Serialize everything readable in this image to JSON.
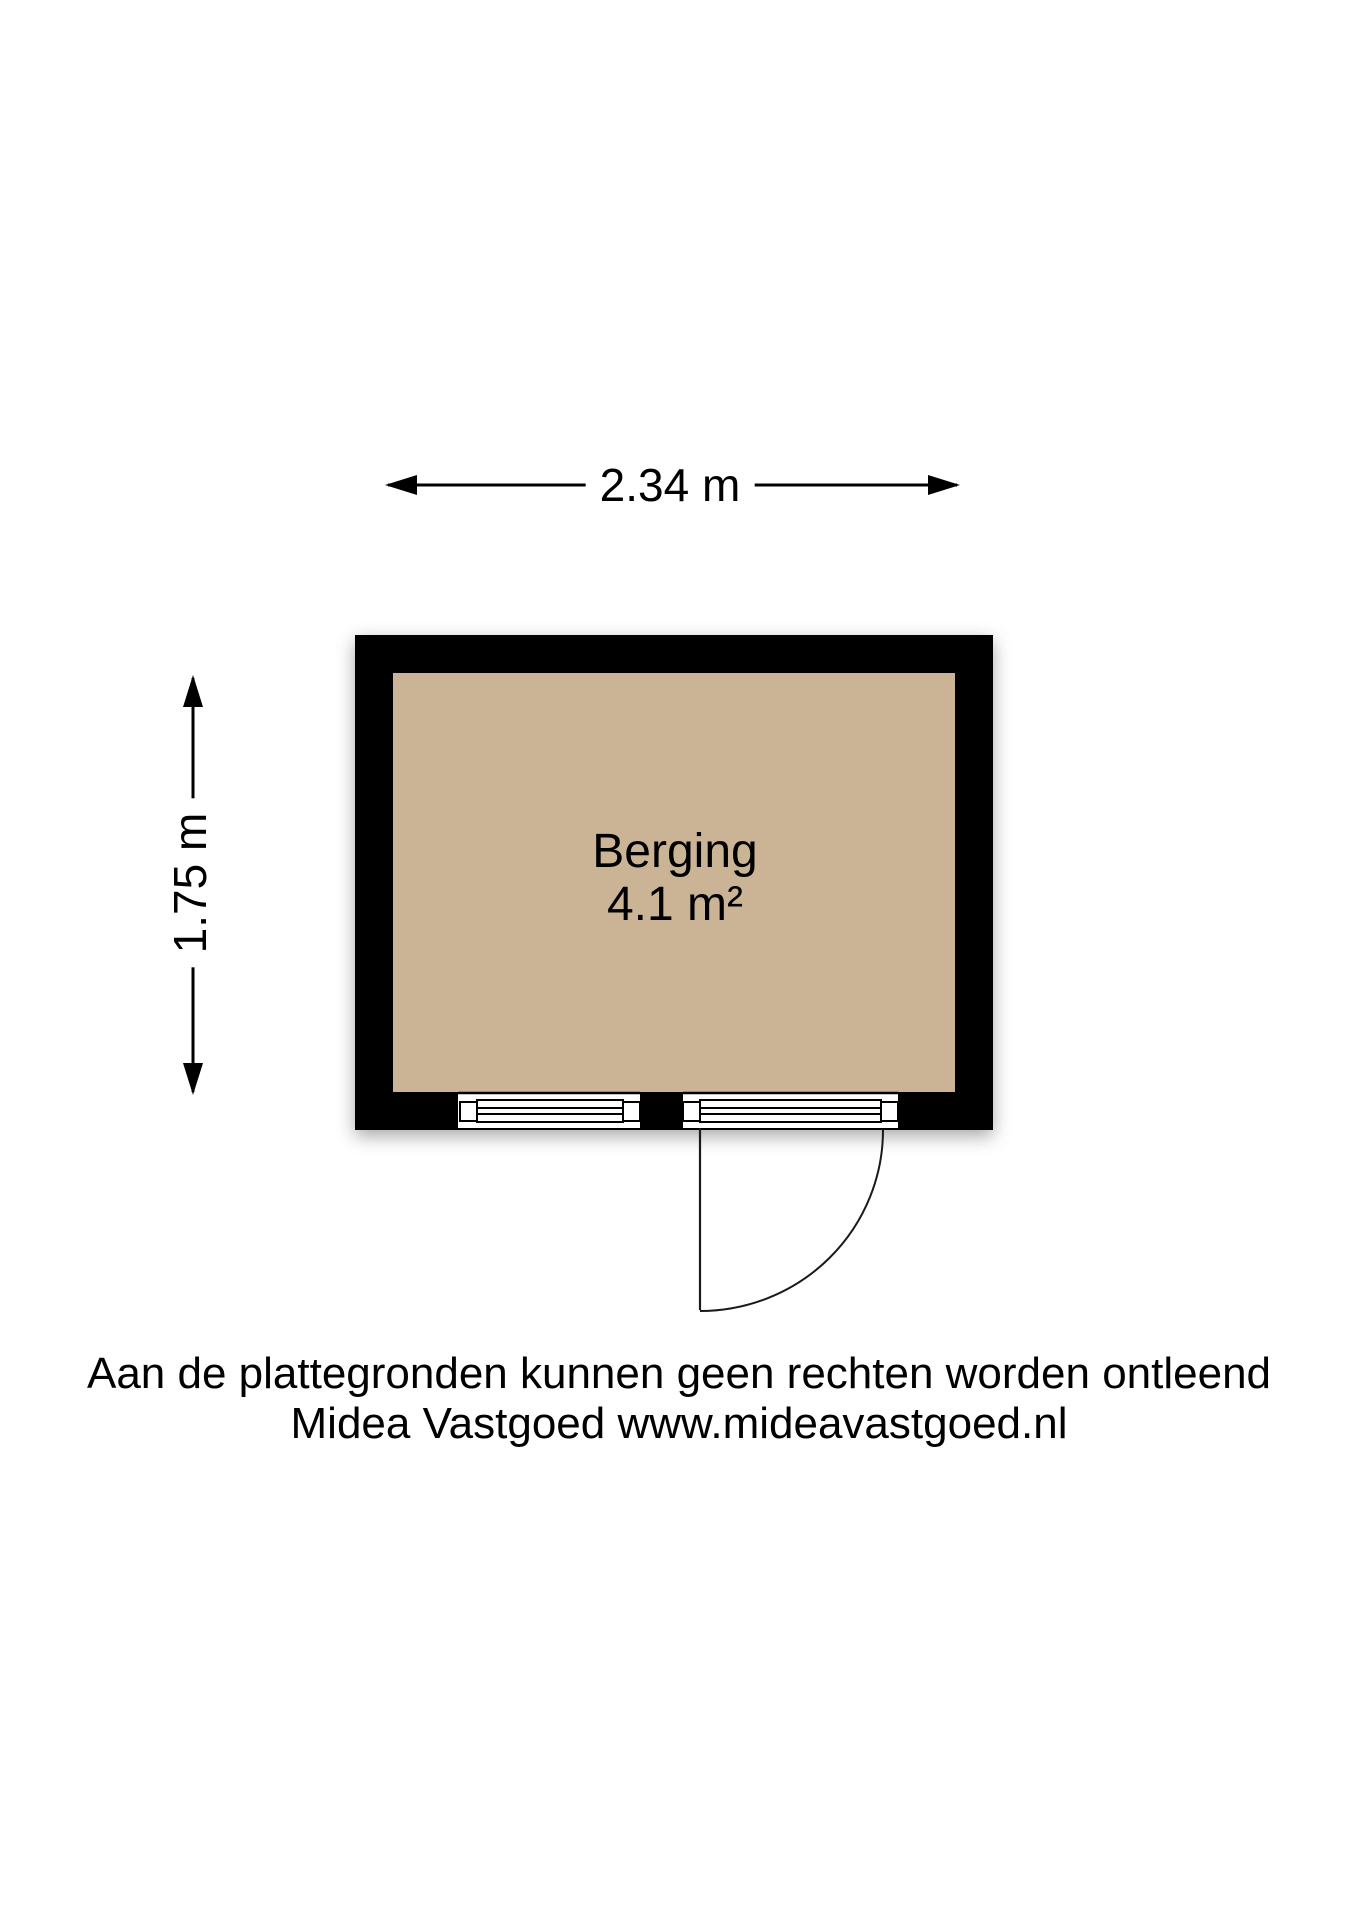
{
  "floorplan": {
    "room": {
      "name": "Berging",
      "area": "4.1 m²"
    },
    "dimensions": {
      "width_label": "2.34 m",
      "height_label": "1.75 m"
    },
    "disclaimer": {
      "line1": "Aan de plattegronden kunnen geen rechten worden ontleend",
      "line2": "Midea Vastgoed www.mideavastgoed.nl"
    },
    "colors": {
      "wall": "#000000",
      "floor": "#cbb495",
      "line": "#000000",
      "background": "#ffffff"
    }
  }
}
